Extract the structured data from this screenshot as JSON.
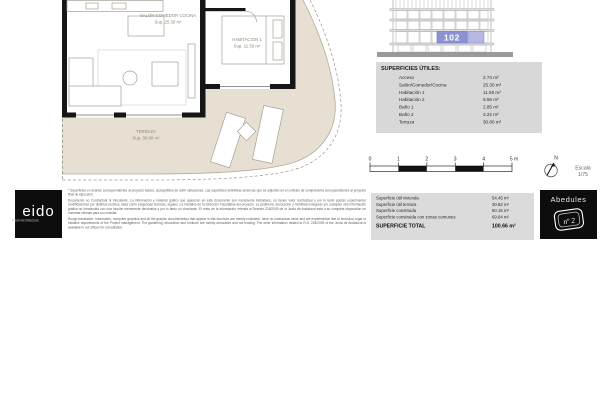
{
  "colors": {
    "terrace_fill": "#e6dfd2",
    "wall": "#161616",
    "highlight_purple": "#8d93d2",
    "highlight_purple_light": "#b4b8e3",
    "panel_gray": "#d8d8d8"
  },
  "plan": {
    "rooms": [
      {
        "name": "SALÓN COMEDOR COCINA",
        "area": "Sup. 25.30 m²"
      },
      {
        "name": "HABITACIÓN 1",
        "area": "Sup. 11.50 m²"
      },
      {
        "name": "TERRAZA",
        "area": "Sup. 30.80 m²"
      }
    ]
  },
  "building": {
    "unit": "102"
  },
  "superficies": {
    "title": "SUPERFICIES ÚTILES:",
    "rows": [
      {
        "label": "Acceso",
        "value": "2.73 m²"
      },
      {
        "label": "Salón/Comedor/Cocina",
        "value": "25.30 m²"
      },
      {
        "label": "Habitación 1",
        "value": "11.50 m²"
      },
      {
        "label": "Habitación 2",
        "value": "9.55 m²"
      },
      {
        "label": "Baño 1",
        "value": "2.85 m²"
      },
      {
        "label": "Baño 2",
        "value": "3.22 m²"
      },
      {
        "label": "Terraza",
        "value": "30.80 m²"
      }
    ]
  },
  "scale": {
    "ticks": [
      "0",
      "1",
      "2",
      "3",
      "4",
      "5 m"
    ],
    "north": "N",
    "escala_line1": "Escala",
    "escala_line2": "1/75"
  },
  "footer": {
    "logo": {
      "brand": "eido",
      "tagline": "Fresh Architecture"
    },
    "legal": {
      "p1": "* Superficies en avance correspondientes al proyecto básico, susceptibles de sufrir variaciones. Las superficies definitivas serán las que se adjunten en el contrato de compraventa correspondientes al proyecto final de ejecución.",
      "p2": "Documento no Contractual ni Vinculante. La información y material gráfico que aparecen en este documento son meramente indicativos, no tienen valor contractual y por lo tanto podrán experimentar modificaciones por distintos motivos, tales como exigencias técnicas, legales o a iniciativa de la Dirección Facultativa del proyecto. La jardinería, decoración y mobiliario integrado y/o cualquier otra información gráfica no introducida con una función meramente decorativa y por lo tanto no vinculante. El resto de la información referida al Decreto 218/2005 de la Junta de Andalucía está a su completa disposición en nuestras oficinas para su consulta.",
      "p3": "Rough translation: Information, computer graphics and all the graphic documentation that appear in this brochure are merely indicative, have no contractual value and are experimental due to technical, legal or initiative requirements of the Project management. The gardening, decoration and furniture are merely decorative and not binding. The other information related to R.D. 218/2005 of the Junta de Andalucía is available in our offices for consultation."
    },
    "summary": {
      "rows": [
        {
          "label": "Superficie útil vivienda",
          "value": "54.45 m²"
        },
        {
          "label": "Superficie útil terraza",
          "value": "30.82 m²"
        },
        {
          "label": "Superficie construida",
          "value": "60.16 m²"
        },
        {
          "label": "Superficie construida con zonas comunes",
          "value": "69.84 m²"
        }
      ],
      "total_label": "SUPERFICIE TOTAL",
      "total_value": "100.66 m²"
    },
    "badge": {
      "name": "Abedules",
      "number": "nº 2"
    }
  }
}
